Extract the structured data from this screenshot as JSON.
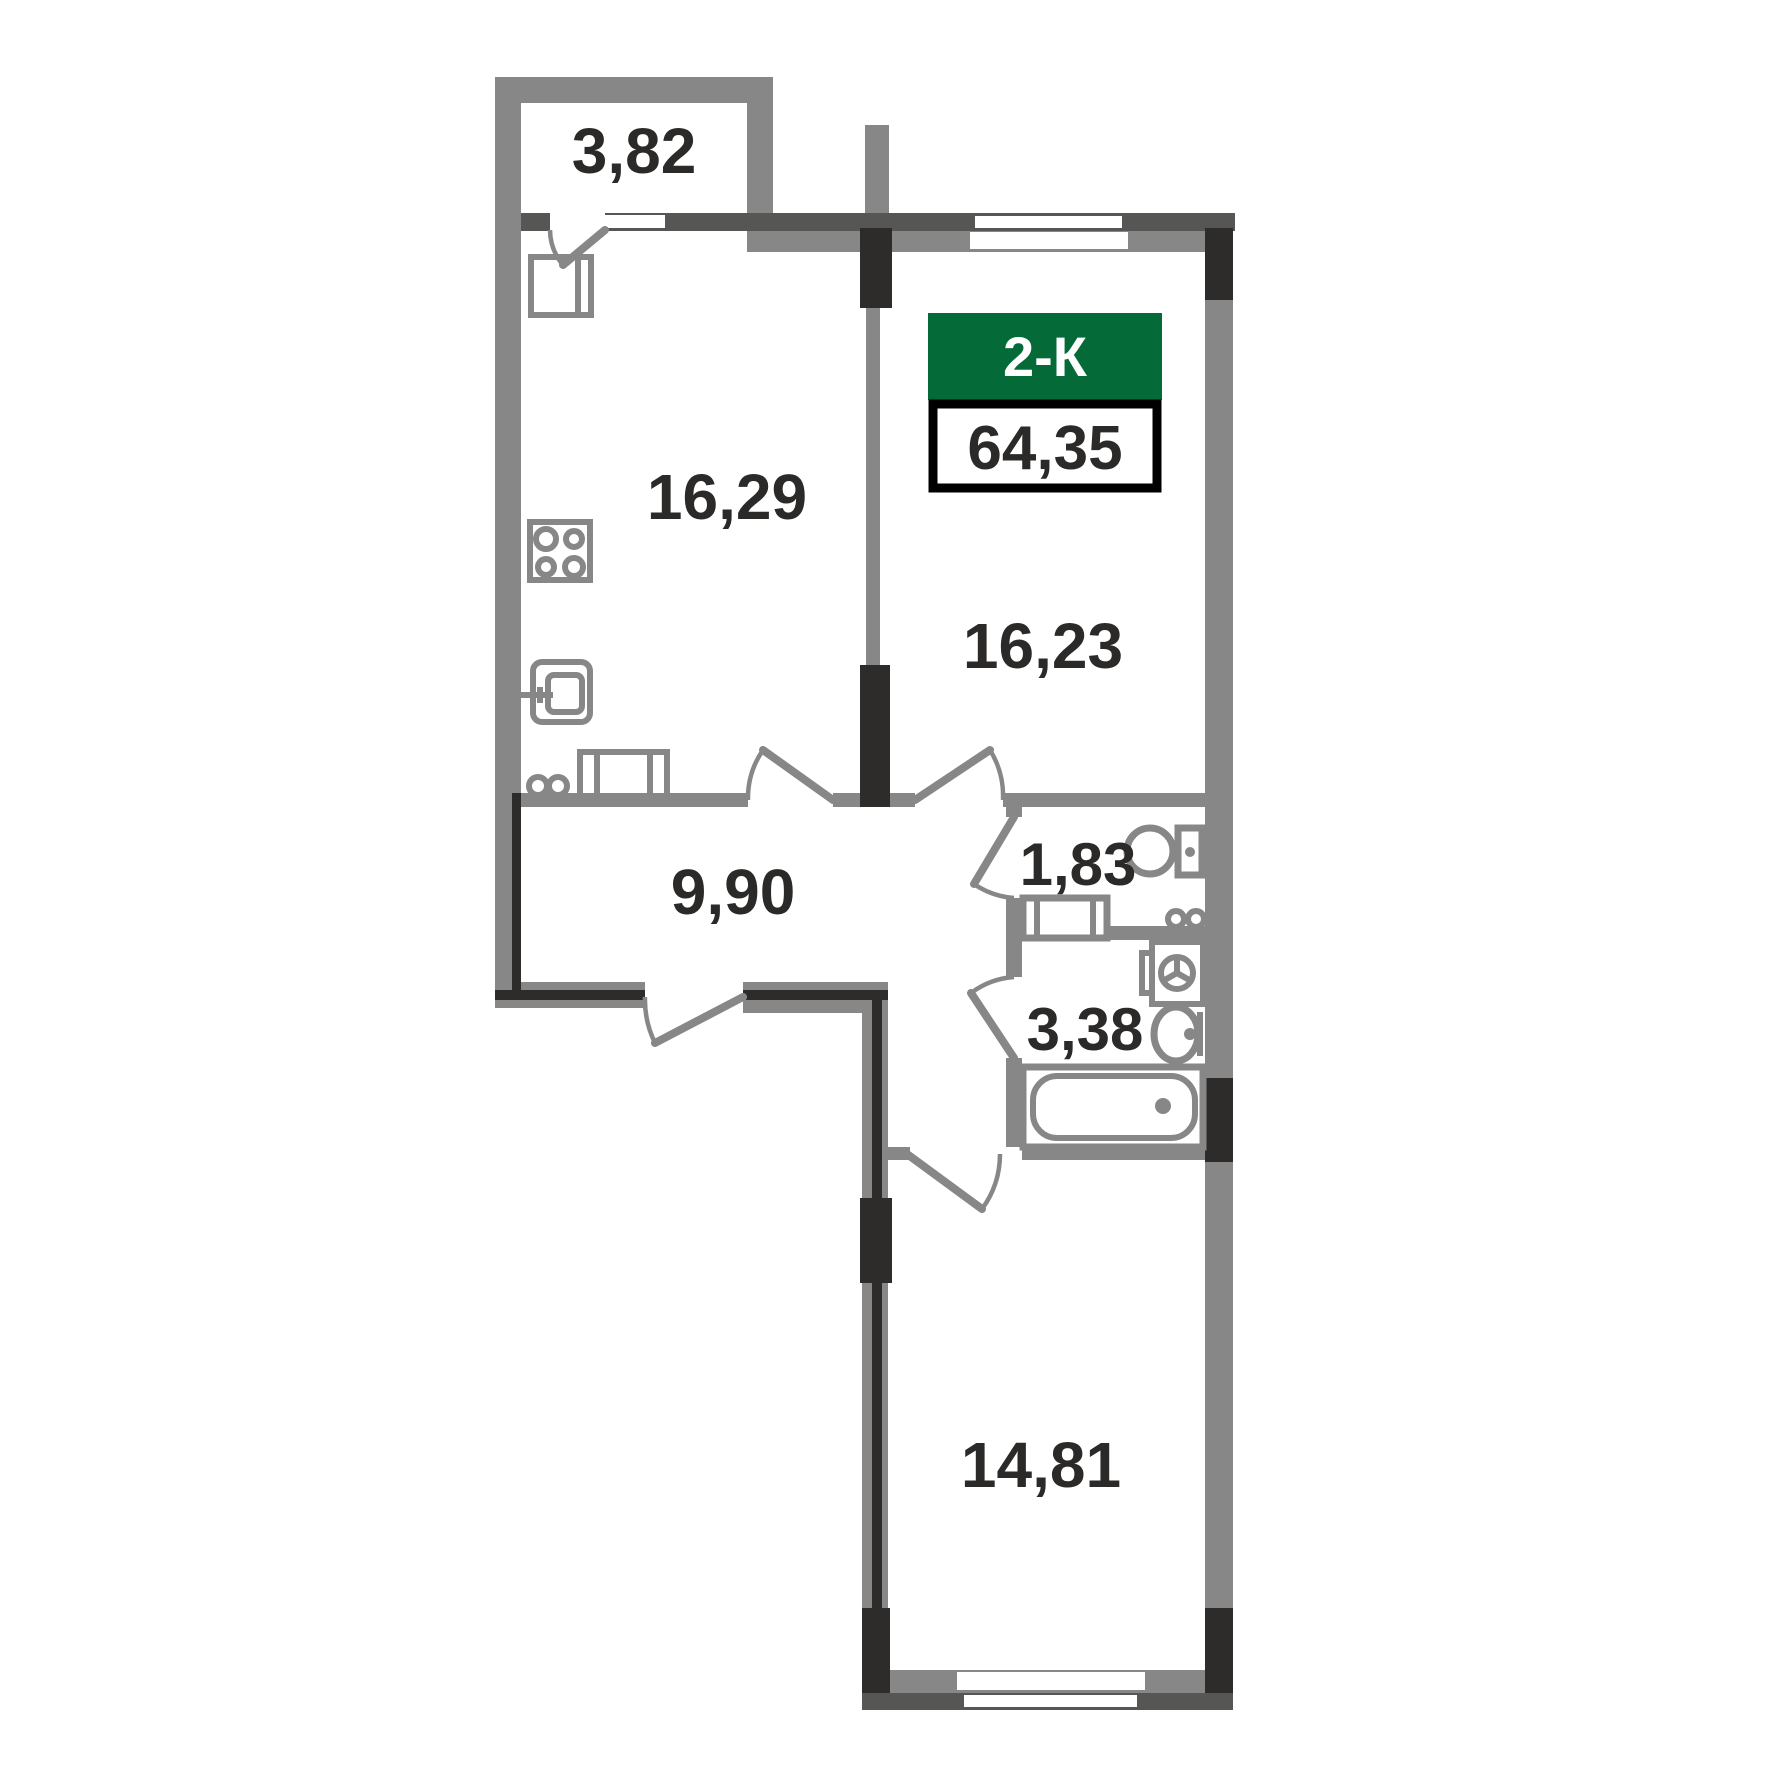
{
  "plan": {
    "title_badge": {
      "type_label": "2-К",
      "total_area": "64,35"
    },
    "rooms": [
      {
        "name": "balcony",
        "area": "3,82"
      },
      {
        "name": "kitchen",
        "area": "16,29"
      },
      {
        "name": "living-room",
        "area": "16,23"
      },
      {
        "name": "hallway",
        "area": "9,90"
      },
      {
        "name": "wc",
        "area": "1,83"
      },
      {
        "name": "bathroom",
        "area": "3,38"
      },
      {
        "name": "bedroom",
        "area": "14,81"
      }
    ],
    "colors": {
      "wall_gray": "#878787",
      "wall_dark": "#565655",
      "wall_black": "#2d2c2b",
      "badge_green": "#046a38",
      "badge_text": "#ffffff",
      "label_text": "#2b2a29",
      "background": "#ffffff"
    }
  }
}
